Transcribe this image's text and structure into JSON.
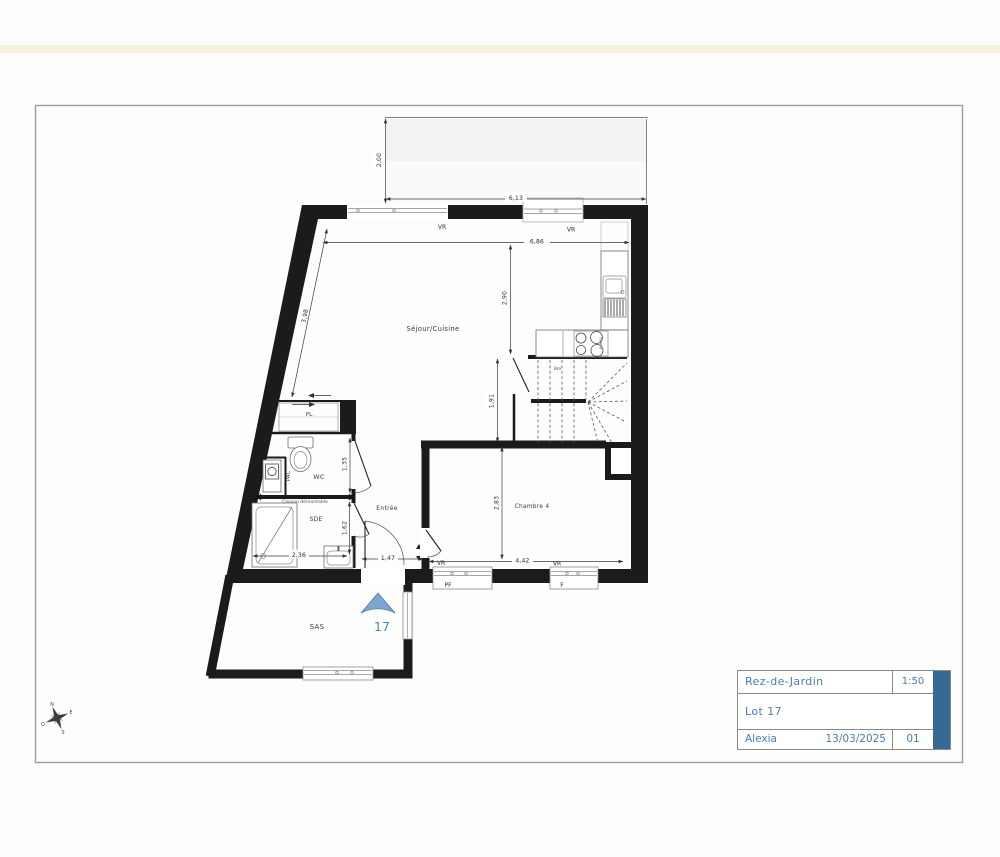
{
  "plan": {
    "rooms": {
      "sejour": "Séjour/Cuisine",
      "pl": "PL.",
      "wc": "WC",
      "pac": "PAC",
      "sde": "SDE",
      "entree": "Entrée",
      "chambre": "Chambre 4",
      "sas": "SAS"
    },
    "openings": {
      "vr": "VR",
      "pf": "PF",
      "f": "F"
    },
    "notes": {
      "partition": "Cloison démontable",
      "stair": "8m",
      "cooktop": "60x60"
    },
    "dimensions": {
      "top_setback": "2,00",
      "top_width": "6,13",
      "living_width": "6,86",
      "living_depth": "2,90",
      "left_wall": "3,98",
      "stair_well": "1,91",
      "wc_depth": "1,35",
      "bedroom_depth": "2,83",
      "bedroom_width": "4,42",
      "sde_width": "2,36",
      "sde_door_wall": "1,62",
      "entry_door": "1,47"
    },
    "unit_number": "17"
  },
  "compass": {
    "n": "N",
    "e": "E",
    "s": "S",
    "o": "O"
  },
  "title_block": {
    "title": "Rez-de-Jardin",
    "scale": "1:50",
    "lot": "Lot 17",
    "author": "Alexia",
    "date": "13/03/2025",
    "index": "01"
  },
  "colors": {
    "wall": "#1b1b1b",
    "accent_bar": "#356a97",
    "title_text": "#4b7dab",
    "entrance_arrow": "#7ba6d2",
    "page_border": "#9b9b9b"
  }
}
